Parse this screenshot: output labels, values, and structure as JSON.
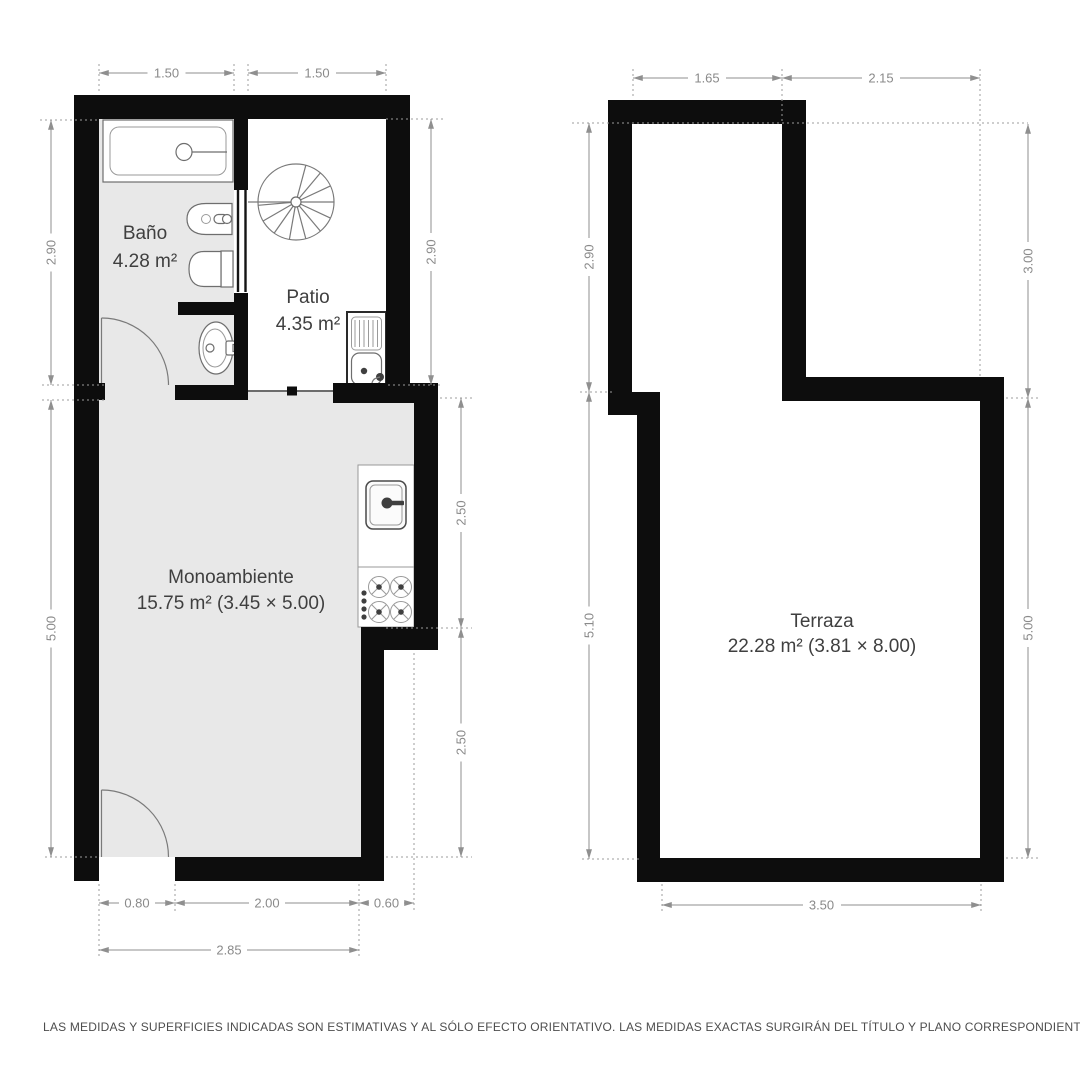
{
  "document": {
    "type": "floor-plan",
    "footer": {
      "disclaimer": "LAS MEDIDAS Y SUPERFICIES INDICADAS SON ESTIMATIVAS Y AL SÓLO EFECTO ORIENTATIVO. LAS MEDIDAS EXACTAS SURGIRÁN DEL TÍTULO Y PLANO CORRESPONDIENTES."
    },
    "colors": {
      "wall": "#0d0d0d",
      "floor": "#e8e8e8",
      "dimension": "#8a8a8a",
      "label": "#3f3f3f"
    }
  },
  "left_plan": {
    "rooms": [
      {
        "id": "bano",
        "name": "Baño",
        "area": "4.28 m²"
      },
      {
        "id": "patio",
        "name": "Patio",
        "area": "4.35 m²"
      },
      {
        "id": "monoambiente",
        "name": "Monoambiente",
        "area": "15.75 m² (3.45 × 5.00)"
      }
    ],
    "dims": {
      "top": [
        "1.50",
        "1.50"
      ],
      "left": [
        "2.90",
        "5.00"
      ],
      "right": [
        "2.90",
        "2.50",
        "2.50"
      ],
      "bottom": [
        "0.80",
        "2.00",
        "0.60",
        "2.85"
      ]
    }
  },
  "right_plan": {
    "rooms": [
      {
        "id": "terraza",
        "name": "Terraza",
        "area": "22.28 m² (3.81 × 8.00)"
      }
    ],
    "dims": {
      "top": [
        "1.65",
        "2.15"
      ],
      "left": [
        "2.90",
        "5.10"
      ],
      "right": [
        "3.00",
        "5.00"
      ],
      "bottom": [
        "3.50"
      ]
    }
  }
}
